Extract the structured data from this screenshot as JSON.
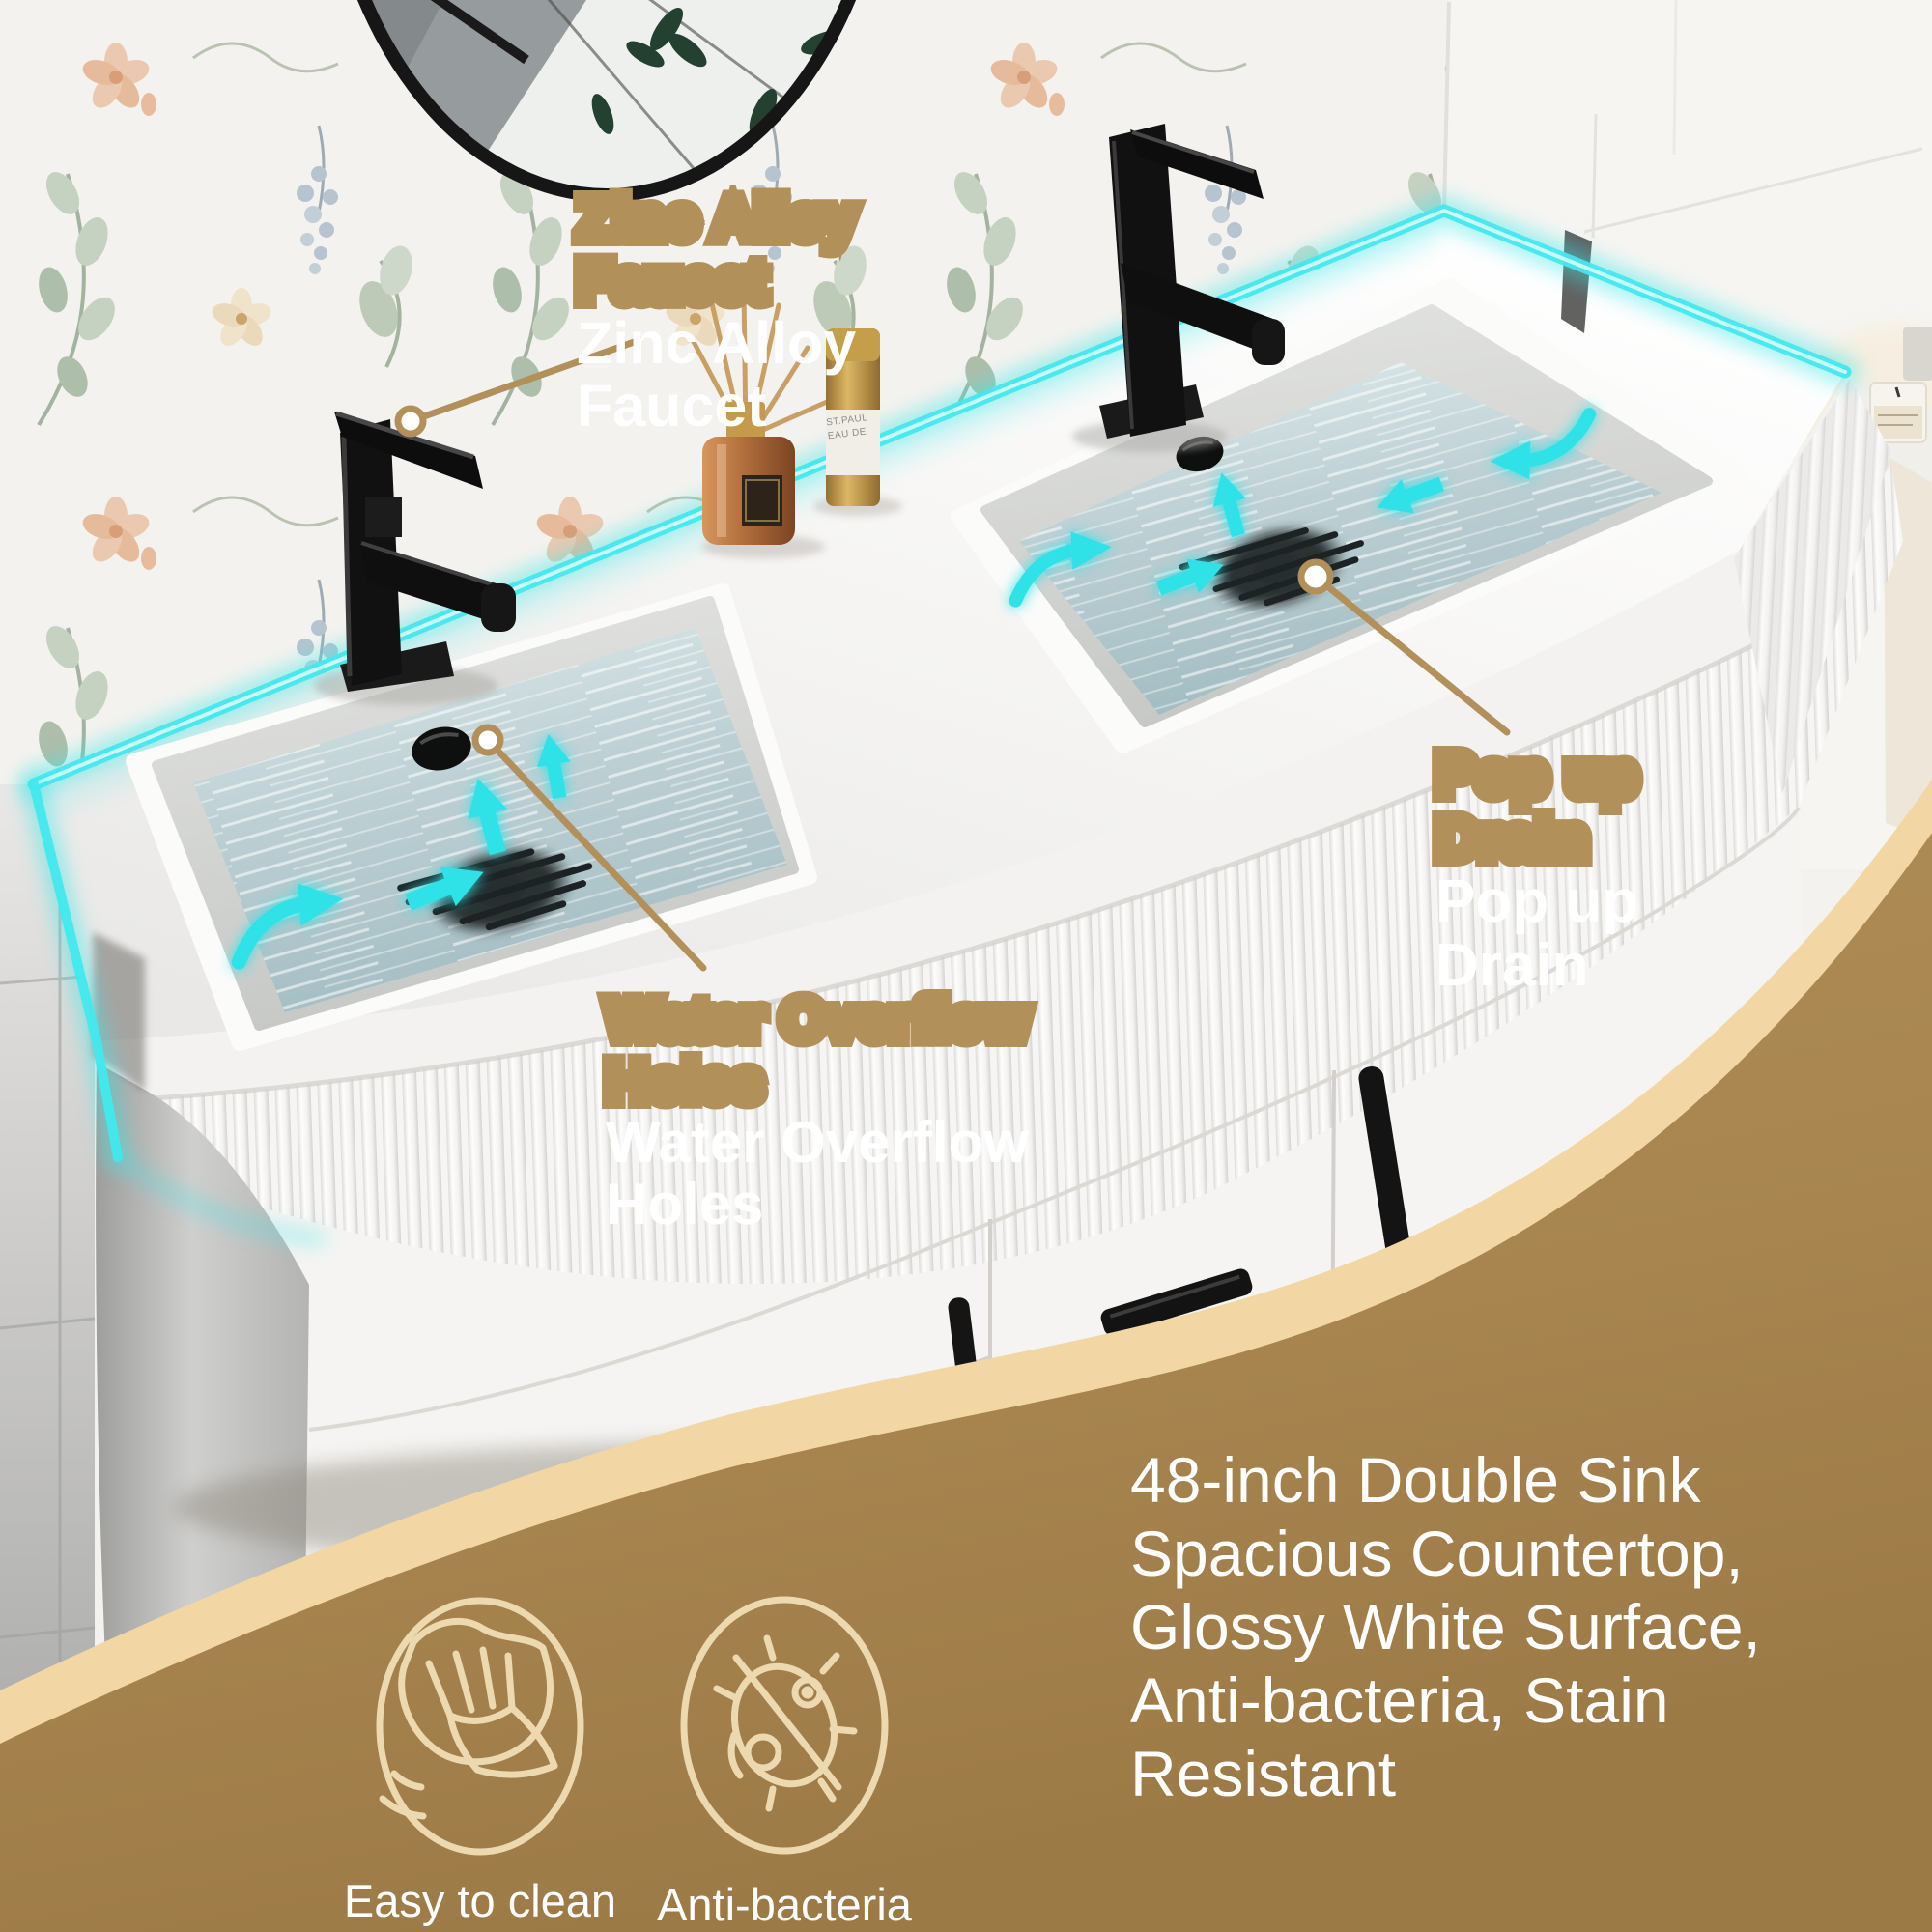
{
  "product": {
    "callout_faucet": "Zinc Alloy\nFaucet",
    "callout_overflow": "Water Overflow\nHoles",
    "callout_drain": "Pop up\nDrain",
    "features_text": "48-inch Double Sink\nSpacious Countertop,\nGlossy White Surface,\nAnti-bacteria, Stain\nResistant",
    "badge_easy_clean": "Easy to clean",
    "badge_anti_bacteria": "Anti-bacteria",
    "canister_label": "ST.PAUL\nEAU DE"
  },
  "colors": {
    "accent_cyan": "#3ae6ea",
    "callout_tan": "#b2905a",
    "overlay_brown": "#a8854f",
    "overlay_cream": "#f2d7a4",
    "icon_cream": "#edd9b0"
  }
}
